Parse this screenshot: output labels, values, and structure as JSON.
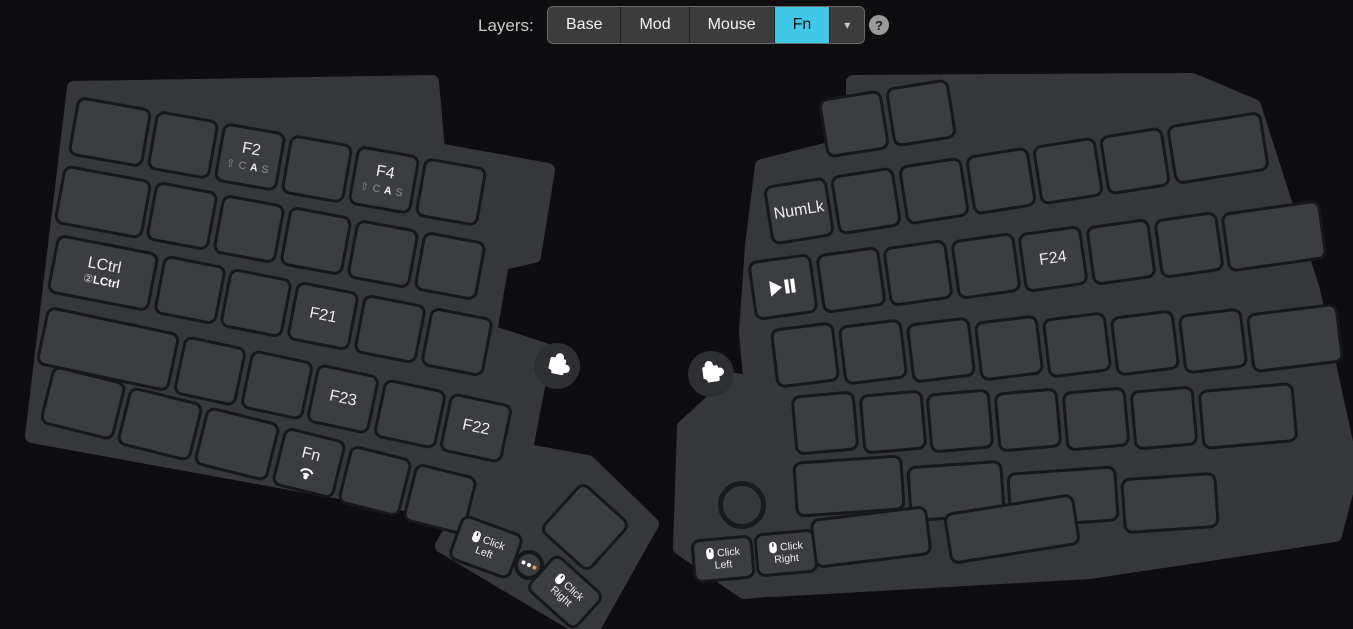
{
  "header": {
    "layers_label": "Layers:",
    "tabs": [
      {
        "label": "Base",
        "active": false
      },
      {
        "label": "Mod",
        "active": false
      },
      {
        "label": "Mouse",
        "active": false
      },
      {
        "label": "Fn",
        "active": true
      }
    ],
    "dropdown_caret": "▾",
    "help_label": "?",
    "active_tab_color": "#41c7e8"
  },
  "legend": {
    "mods_parts": [
      "⇧",
      "C",
      "A",
      "S"
    ],
    "mods_highlight_index": 2,
    "double_tap_prefix": "②"
  },
  "colors": {
    "background": "#0e0e10",
    "plate": "#37383b",
    "key": "#3c3d40",
    "key_gap": "#17181a",
    "key_text": "#ececec",
    "sub_text": "#8f9094",
    "led_dot_orange": "#e0a053",
    "led_dot_white": "#ffffff"
  },
  "keyboard": {
    "left_rows": [
      [
        {
          "label": ""
        },
        {
          "label": ""
        },
        {
          "label": "F2",
          "sub": "mods"
        },
        {
          "label": ""
        },
        {
          "label": "F4",
          "sub": "mods"
        },
        {
          "label": ""
        }
      ],
      [
        {
          "label": ""
        },
        {
          "label": ""
        },
        {
          "label": ""
        },
        {
          "label": ""
        },
        {
          "label": ""
        },
        {
          "label": ""
        }
      ],
      [
        {
          "label": "LCtrl",
          "sub": "dtap",
          "sub_label": "LCtrl"
        },
        {
          "label": ""
        },
        {
          "label": ""
        },
        {
          "label": "F21"
        },
        {
          "label": ""
        },
        {
          "label": ""
        }
      ],
      [
        {
          "label": ""
        },
        {
          "label": ""
        },
        {
          "label": ""
        },
        {
          "label": "F23"
        },
        {
          "label": ""
        },
        {
          "label": "F22"
        }
      ],
      [
        {
          "label": ""
        },
        {
          "label": ""
        },
        {
          "label": ""
        },
        {
          "label": "Fn",
          "sub": "signal"
        },
        {
          "label": ""
        },
        {
          "label": ""
        }
      ]
    ],
    "left_thumb": [
      {
        "label": "",
        "name": "key-blank-square"
      },
      {
        "label": "Click",
        "label2": "Left",
        "icon": "mouse",
        "name": "key-click-left"
      },
      {
        "label": "Click",
        "label2": "Right",
        "icon": "mouse",
        "name": "key-click-right"
      }
    ],
    "right_rows": [
      [
        {
          "label": ""
        },
        {
          "label": ""
        }
      ],
      [
        {
          "label": "NumLk"
        },
        {
          "label": ""
        },
        {
          "label": ""
        },
        {
          "label": ""
        },
        {
          "label": ""
        },
        {
          "label": ""
        },
        {
          "label": ""
        }
      ],
      [
        {
          "label": "",
          "sub": "playpause"
        },
        {
          "label": ""
        },
        {
          "label": ""
        },
        {
          "label": ""
        },
        {
          "label": "F24"
        },
        {
          "label": ""
        },
        {
          "label": ""
        },
        {
          "label": ""
        }
      ],
      [
        {
          "label": ""
        },
        {
          "label": ""
        },
        {
          "label": ""
        },
        {
          "label": ""
        },
        {
          "label": ""
        },
        {
          "label": ""
        },
        {
          "label": ""
        },
        {
          "label": ""
        }
      ],
      [
        {
          "label": ""
        },
        {
          "label": ""
        },
        {
          "label": ""
        },
        {
          "label": ""
        },
        {
          "label": ""
        },
        {
          "label": ""
        },
        {
          "label": ""
        }
      ],
      [
        {
          "label": ""
        },
        {
          "label": ""
        },
        {
          "label": ""
        },
        {
          "label": ""
        }
      ]
    ],
    "right_thumb": [
      {
        "label": "Click",
        "label2": "Left",
        "icon": "mouse",
        "name": "key-click-left"
      },
      {
        "label": "Click",
        "label2": "Right",
        "icon": "mouse",
        "name": "key-click-right"
      },
      {
        "label": "",
        "name": "key-blank-wide"
      },
      {
        "label": "",
        "name": "key-blank-wide"
      }
    ]
  }
}
